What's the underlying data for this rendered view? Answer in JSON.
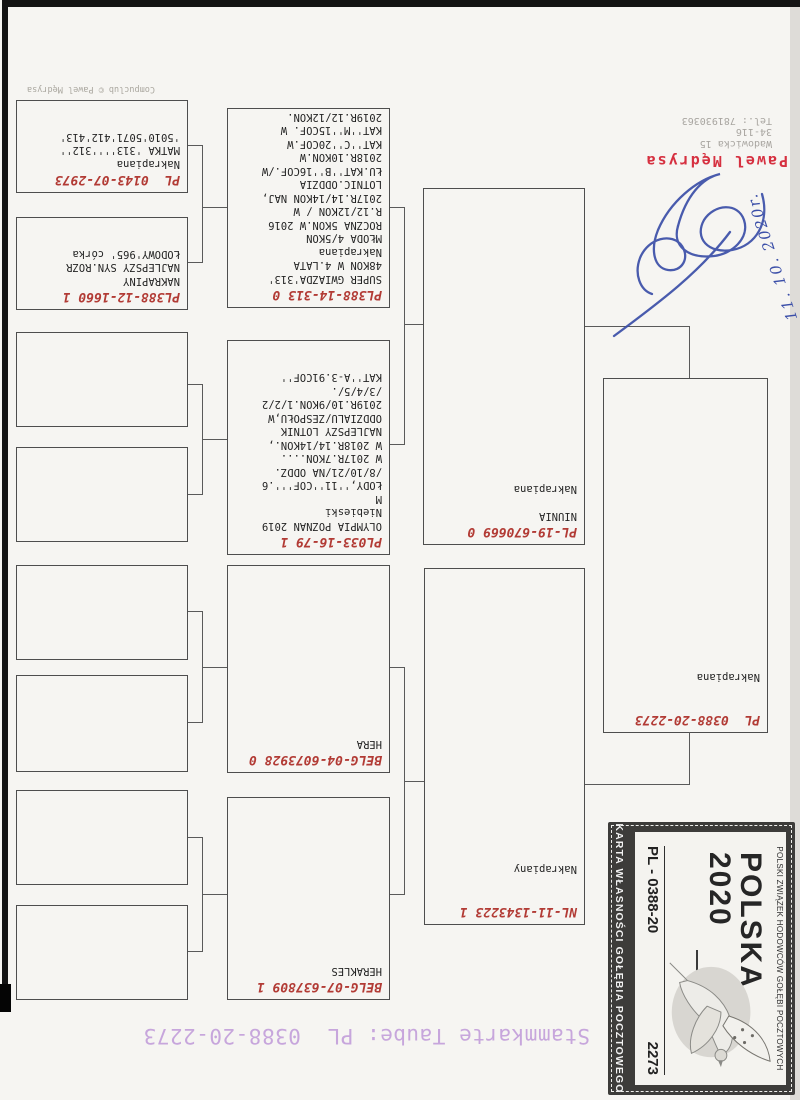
{
  "document": {
    "title": "Stammkarte Taube: PL  0388-20-2273",
    "watermark": "Compuclub © Pawel Mędrysa",
    "breeder": {
      "name": "Pawel Mędrysa",
      "street": "Wadowicka 15",
      "postal_code": "34-116",
      "phone": "Tel.: 781930363",
      "handwritten_date": "11. 10. 2020r."
    }
  },
  "stamp": {
    "federation": "POLSKI ZWIĄZEK HODOWCÓW GOŁĘBI POCZTOWYCH",
    "country_line1": "POLSKA",
    "country_line2": "2020",
    "ring_prefix": "PL - 0388-20",
    "ring_serial": "2273",
    "card_label": "KARTA WŁASNOŚCI GOŁĘBIA POCZTOWEGO"
  },
  "pedigree": {
    "subject": {
      "ring": "PL  0388-20-2273",
      "lines": [
        "",
        "",
        "Nakrapiana"
      ]
    },
    "father": {
      "ring": "NL-11-1343223 1",
      "lines": [
        "",
        "",
        "Nakrapiany"
      ]
    },
    "mother": {
      "ring": "PL-19-670669 0",
      "lines": [
        "NIUNIA",
        "",
        "Nakrapiana"
      ]
    },
    "grandparents": [
      {
        "ring": "BELG-07-637809 1",
        "lines": [
          "HERAKLES"
        ]
      },
      {
        "ring": "BELG-04-6073928 0",
        "lines": [
          "HERA"
        ]
      },
      {
        "ring": "PL033-16-79 1",
        "lines": [
          "OLYMPIA POZNAN 2019",
          "Niebieski",
          "M",
          "ŁODY,''11''COF'''.6",
          "/8/10/21/NA ODDZ.",
          "W 2017R.7KON....",
          "W 2018R.14/14KON.,",
          "NAJLEPSZY LOTNIK",
          "ODDZIALU/ZESPOŁU,W",
          "2019R.10/9KON.1/2/2",
          "/3/4/5/.",
          "KAT''A-3.91COF''"
        ]
      },
      {
        "ring": "PL388-14-313 0",
        "lines": [
          "SUPER GWIAZDA'313'",
          "48KON W 4.LATA",
          "Nakrapiana",
          "MŁODA 4/5KON",
          "ROCZNA 5KON.W 2016",
          "R.12/12KON / W",
          "2017R.14/14KON NAJ,",
          "LOTNIC.ODDZIA",
          "ŁU.KAT''B''16COF./W",
          "2018R.10KON.W",
          "KAT''C''20COF.W",
          "KAT''M''15COF. W",
          "2019R.12/12KON."
        ]
      }
    ],
    "great_grandparents": [
      {
        "ring": "",
        "lines": []
      },
      {
        "ring": "",
        "lines": []
      },
      {
        "ring": "",
        "lines": []
      },
      {
        "ring": "",
        "lines": []
      },
      {
        "ring": "",
        "lines": []
      },
      {
        "ring": "",
        "lines": []
      },
      {
        "ring": "PL388-12-1660 1",
        "lines": [
          "NAKRAPINY",
          "NAJLEPSZY SYN.ROZR",
          "ŁODOWY'965' córka"
        ]
      },
      {
        "ring": "PL  0143-07-2973",
        "lines": [
          "Nakrapiana",
          "MATKA '313''''312''",
          "'5010'5071'412'413'"
        ]
      }
    ]
  }
}
